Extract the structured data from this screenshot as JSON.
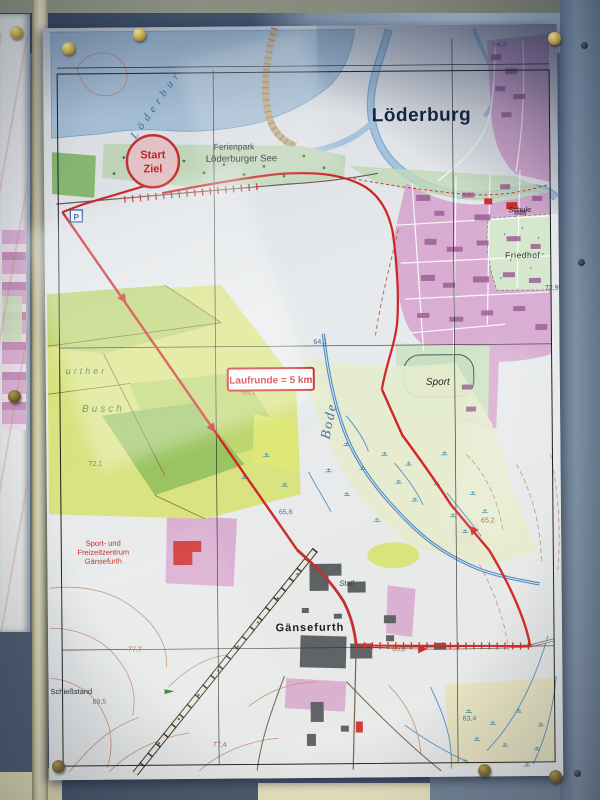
{
  "map": {
    "title": "Löderburg",
    "lake_label": "Löderbur",
    "start_line1": "Start",
    "start_line2": "Ziel",
    "ferienpark_line1": "Ferienpark",
    "ferienpark_line2": "Löderburger See",
    "route_box": "Laufrunde = 5 km",
    "river": "Bode",
    "sport": "Sport",
    "friedhof": "Friedhof",
    "schule": "Schule",
    "gaensefurth": "Gänsefurth",
    "stall": "Stall",
    "freizeit_line1": "Sport- und",
    "freizeit_line2": "Freizeitzentrum",
    "freizeit_line3": "Gänsefurth",
    "schiessstand": "Schießstand",
    "busch_line1": "urther",
    "busch_line2": "Busch",
    "parking": "P",
    "elev": {
      "e643": "64,3",
      "e729": "72,9",
      "e641": "64,1",
      "e661": "66,1",
      "e721": "72,1",
      "e656": "65,6",
      "e652": "65,2",
      "e658": "65,8",
      "e634": "63,4",
      "e777": "77,7",
      "e695": "69,5",
      "e774": "77,4"
    }
  },
  "colors": {
    "route_red": "#cf2222",
    "water_blue": "#8fb8d8",
    "town_pink": "#d9add2",
    "field_green": "#d8e37f",
    "forest_green": "#98c360",
    "board_blue": "#5e7088",
    "frame_cream": "#ece7c0",
    "pin_brass": "#d8bb4e"
  }
}
